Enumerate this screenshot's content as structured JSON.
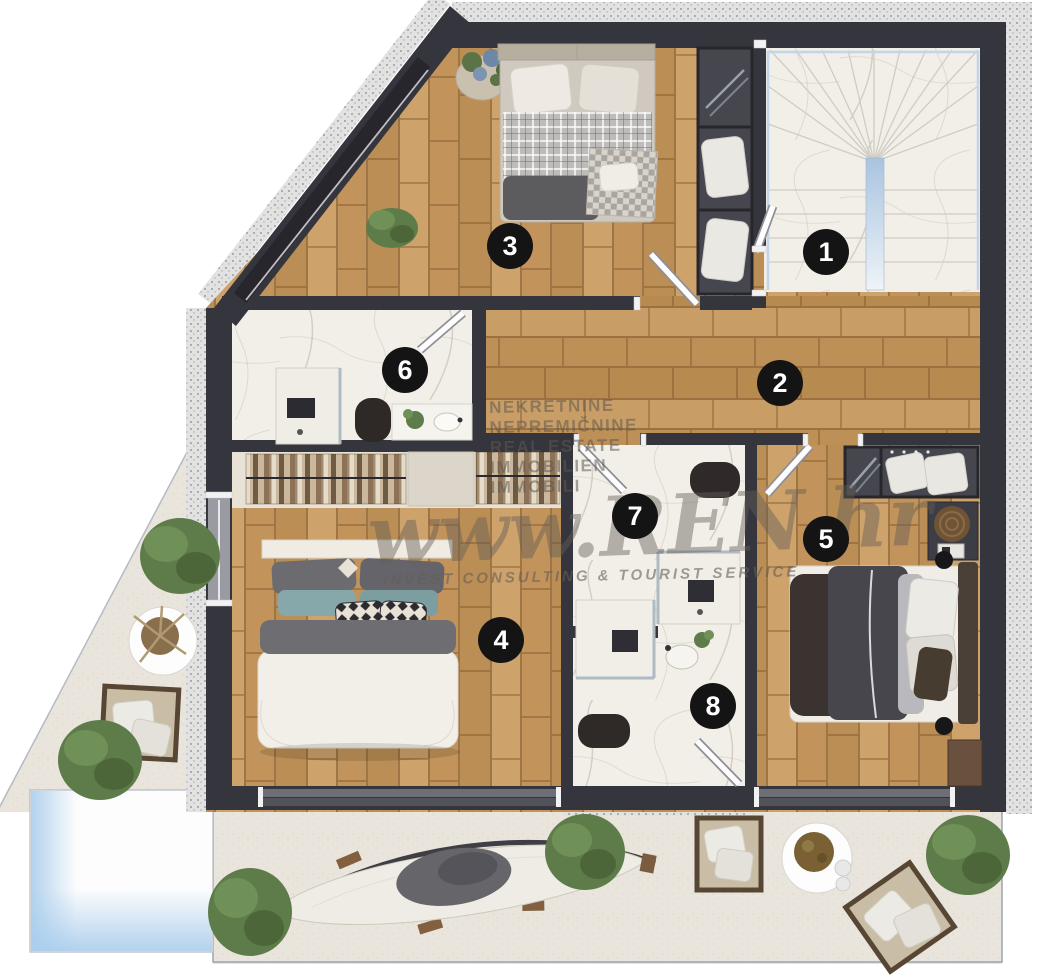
{
  "watermark": {
    "lines": [
      "NEKRETNINE",
      "NEPREMIČNINE",
      "REAL ESTATE",
      "IMMOBILIEN",
      "IMMOBILI"
    ],
    "brand": "www.REN.hr",
    "tagline": "INVEST CONSULTING & TOURIST SERVICE"
  },
  "rooms": [
    {
      "number": "1"
    },
    {
      "number": "2"
    },
    {
      "number": "3"
    },
    {
      "number": "4"
    },
    {
      "number": "5"
    },
    {
      "number": "6"
    },
    {
      "number": "7"
    },
    {
      "number": "8"
    }
  ],
  "colors": {
    "wall": "#35353d",
    "wood_floor": "#c49a63",
    "marble_floor": "#f2efe8",
    "terrace": "#eae5dc",
    "pool_water": "#a9cdec",
    "badge": "#141414",
    "watermark_text": "#5f584e"
  }
}
